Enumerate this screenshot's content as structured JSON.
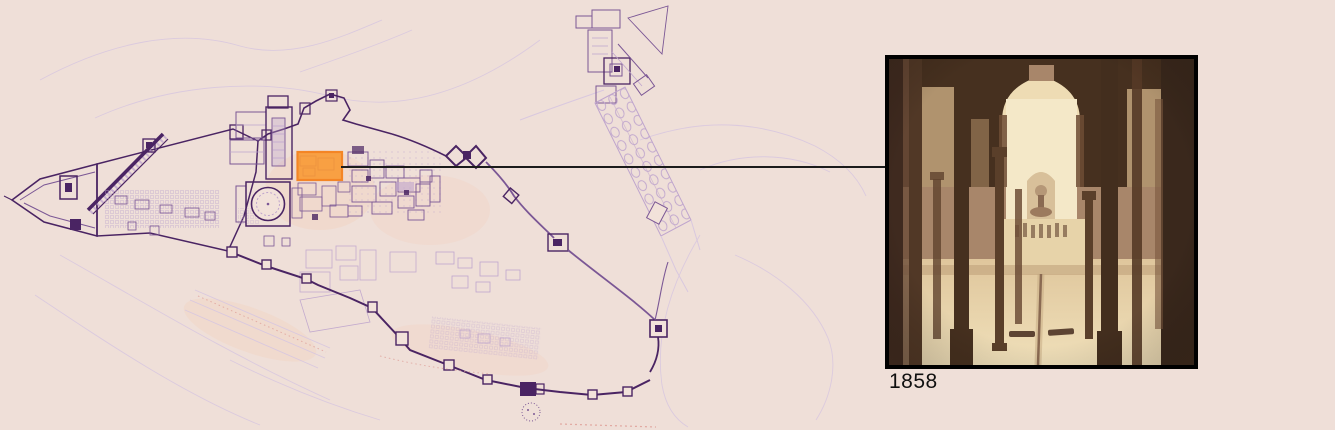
{
  "page": {
    "background": "#efdfd8"
  },
  "map": {
    "title": "alhambra-site-plan",
    "colors": {
      "ink_bold": "#4a2463",
      "ink_mid": "#7b5795",
      "ink_light": "#bfa5cd",
      "ink_faint": "#d9c8df",
      "accent_red": "#dd9a94",
      "wash": "#f5c09a",
      "paper": "#f2e2da"
    },
    "highlight": {
      "fill": "#f99a35",
      "stroke": "#f57d13"
    }
  },
  "connector": {
    "color": "#1b1b1b"
  },
  "photo": {
    "caption": "1858",
    "frame_color": "#000000",
    "caption_color": "#101010",
    "palette": {
      "dark": "#46301f",
      "shadow": "#6d4c35",
      "mid": "#a8866a",
      "light": "#eedcb4",
      "bright": "#f4e8c8"
    }
  }
}
